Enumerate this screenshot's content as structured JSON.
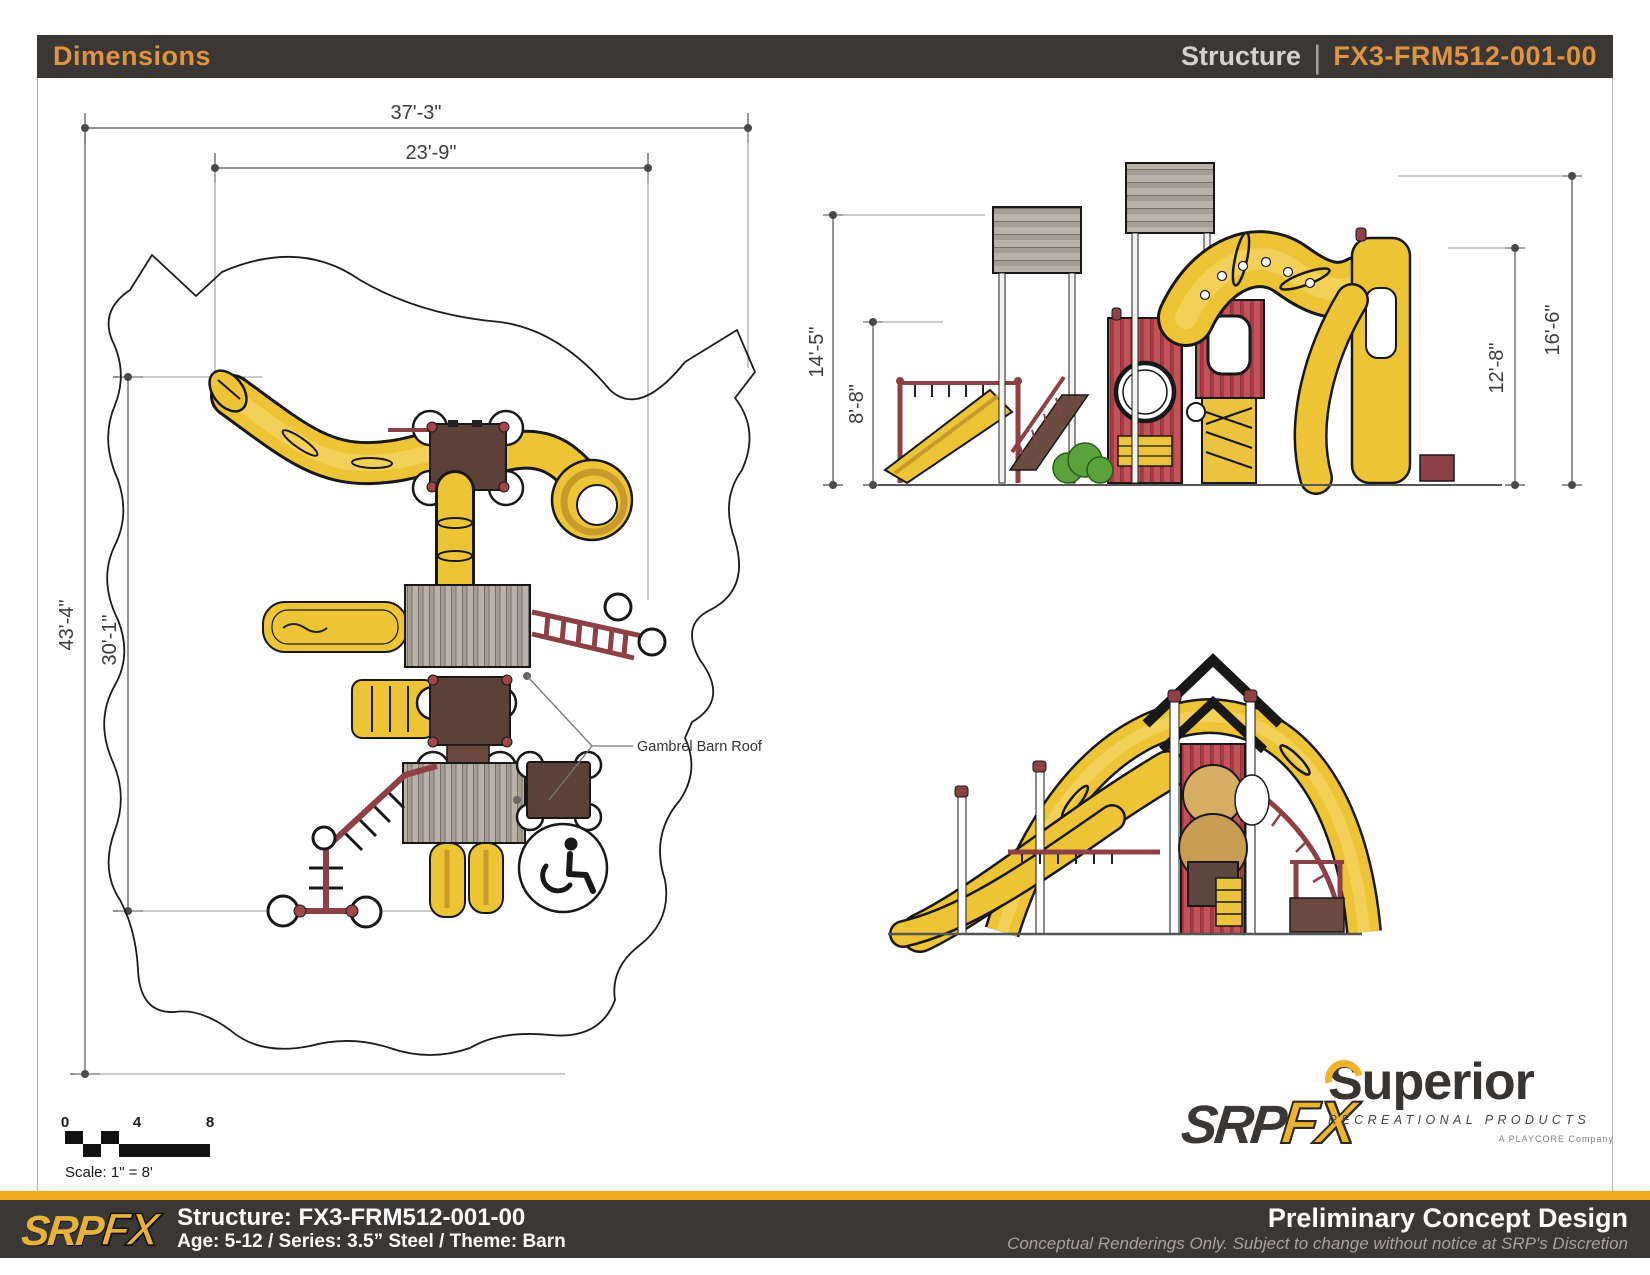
{
  "header": {
    "title": "Dimensions",
    "category_label": "Structure",
    "divider": "|",
    "structure_id": "FX3-FRM512-001-00"
  },
  "plan_view": {
    "dim_overall_width": "37'-3\"",
    "dim_inner_width": "23'-9\"",
    "dim_overall_depth": "43'-4\"",
    "dim_inner_depth": "30'-1\"",
    "roof_callout": "Gambrel Barn Roof"
  },
  "side_view": {
    "dim_roof_height": "14'-5\"",
    "dim_deck_height": "8'-8\"",
    "dim_tower_roof_height": "16'-6\"",
    "dim_slide_height": "12'-8\""
  },
  "scale_bar": {
    "tick_0": "0",
    "tick_4": "4",
    "tick_8": "8",
    "label": "Scale: 1\" = 8'"
  },
  "branding": {
    "srpfx_srp": "SRP",
    "srpfx_fx": "FX",
    "superior_name": "Superior",
    "superior_subtitle": "RECREATIONAL PRODUCTS",
    "playcore_line": "A PLAYCORE Company"
  },
  "footer": {
    "logo_srp": "SRP",
    "logo_fx": "FX",
    "structure_line": "Structure: FX3-FRM512-001-00",
    "details_line": "Age: 5-12 / Series: 3.5” Steel / Theme: Barn",
    "status_title": "Preliminary Concept Design",
    "disclaimer": "Conceptual Renderings Only. Subject to change without notice at SRP's Discretion"
  },
  "colors": {
    "accent_orange": "#E09440",
    "stripe_yellow": "#F2A81D",
    "header_bar": "#3B3734",
    "equipment_yellow": "#EEC437",
    "equipment_maroon": "#8D4045",
    "barn_red": "#C0494F",
    "deck_brown": "#5F463C",
    "roof_gray": "#B7B0A8"
  }
}
